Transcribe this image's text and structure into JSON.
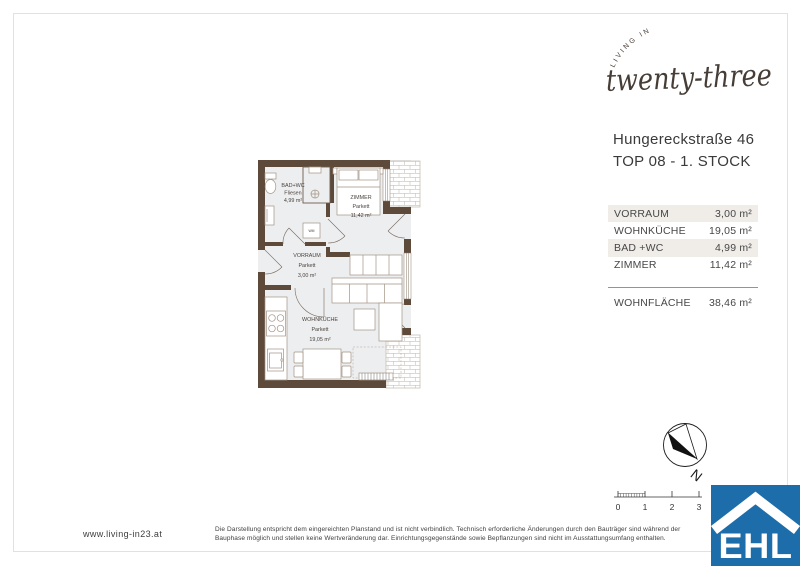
{
  "logo": {
    "top_text": "LIVING IN",
    "script_text": "twenty-three",
    "color": "#463d36"
  },
  "header": {
    "address_line1": "Hungereckstraße 46",
    "address_line2": "TOP 08 - 1. STOCK"
  },
  "area_table": {
    "rows": [
      {
        "label": "VORRAUM",
        "value": "3,00 m²"
      },
      {
        "label": "WOHNKÜCHE",
        "value": "19,05 m²"
      },
      {
        "label": "BAD +WC",
        "value": "4,99 m²"
      },
      {
        "label": "ZIMMER",
        "value": "11,42 m²"
      }
    ],
    "total": {
      "label": "WOHNFLÄCHE",
      "value": "38,46 m²"
    }
  },
  "floor_plan": {
    "wall_color": "#5e4a3a",
    "floor_color": "#edeef0",
    "rooms": [
      {
        "name": "BAD+WC",
        "floor": "Fliesen",
        "area": "4,99 m²"
      },
      {
        "name": "ZIMMER",
        "floor": "Parkett",
        "area": "11,42 m²"
      },
      {
        "name": "VORRAUM",
        "floor": "Parkett",
        "area": "3,00 m²"
      },
      {
        "name": "WOHNKÜCHE",
        "floor": "Parkett",
        "area": "19,05 m²"
      }
    ],
    "appliance_label": "WM"
  },
  "compass": {
    "label": "N"
  },
  "scale_bar": {
    "labels": [
      "0",
      "1",
      "2",
      "3"
    ]
  },
  "footer": {
    "website": "www.living-in23.at",
    "disclaimer_line1": "Die Darstellung entspricht dem eingereichten Planstand und ist nicht verbindlich. Technisch erforderliche Änderungen durch den Bauträger sind während der",
    "disclaimer_line2": "Bauphase möglich und stellen keine Wertveränderung dar. Einrichtungsgegenstände sowie Bepflanzungen sind nicht im Ausstattungsumfang enthalten."
  },
  "ehl": {
    "text": "EHL",
    "color": "#1d6dab"
  }
}
